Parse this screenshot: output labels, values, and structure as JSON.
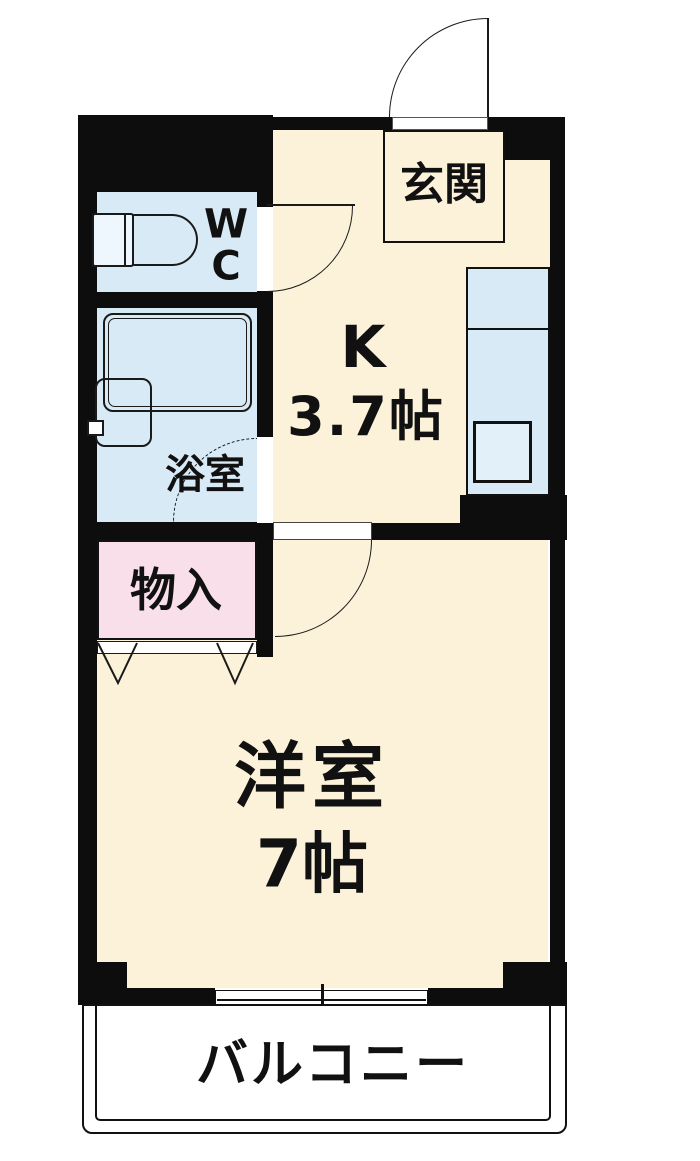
{
  "floorplan": {
    "type": "japanese-apartment-floorplan",
    "rooms": {
      "genkan": {
        "label": "玄関"
      },
      "wc": {
        "line1": "W",
        "line2": "C"
      },
      "bath": {
        "label": "浴室"
      },
      "kitchen": {
        "name": "K",
        "size": "3.7帖"
      },
      "storage": {
        "label": "物入"
      },
      "western": {
        "name": "洋室",
        "size": "7帖"
      },
      "balcony": {
        "label": "バルコニー"
      }
    },
    "icons": [
      "entrance-door-icon",
      "wc-door-icon",
      "bath-door-icon",
      "room-door-icon",
      "closet-folding-door-icon",
      "toilet-icon",
      "bathtub-icon",
      "washbasin-icon",
      "kitchen-counter-icon",
      "sink-icon",
      "sliding-window-icon",
      "balcony-rail-icon"
    ],
    "colors": {
      "wall": "#0d0d0d",
      "floor_cream": "#fbf2d9",
      "wet_area_blue": "#d9eaf7",
      "closet_pink": "#f8dfe9",
      "line": "#1a1a1a",
      "background": "#ffffff"
    }
  }
}
